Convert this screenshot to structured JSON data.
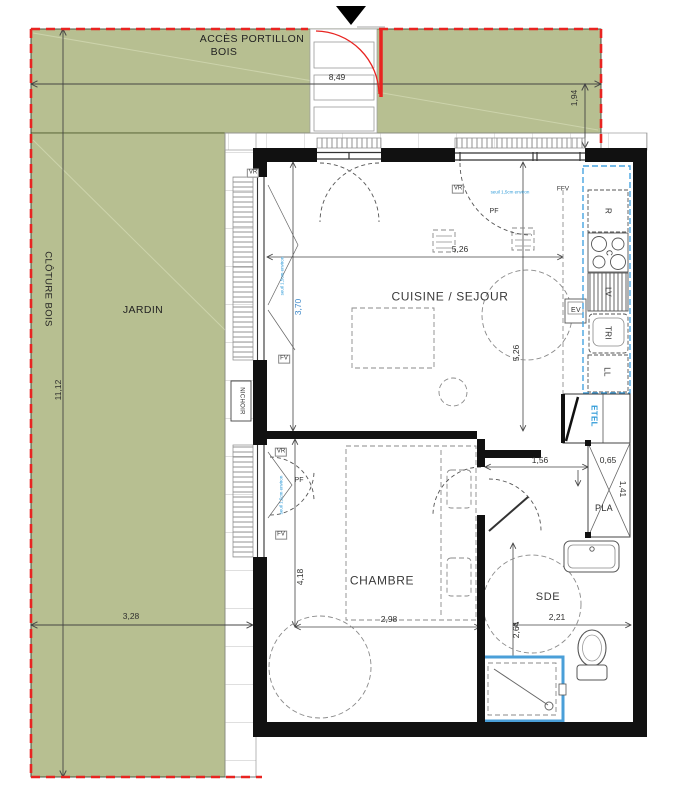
{
  "site": {
    "access_line1": "ACCÈS PORTILLON",
    "access_line2": "BOIS",
    "fence": "CLÔTURE BOIS",
    "garden": "JARDIN",
    "nichoir": "NICHOIR"
  },
  "rooms": {
    "living": "CUISINE / SEJOUR",
    "bedroom": "CHAMBRE",
    "bathroom": "SDE",
    "wardrobe": "PLA"
  },
  "kitchen": {
    "fridge": "R",
    "cooktop": "C",
    "dishwasher": "LV",
    "sink": "EV",
    "sorting": "TRI",
    "washer": "LL",
    "utility": "ETEL"
  },
  "openings": {
    "vr": "VR",
    "fv": "FV",
    "ffv": "FFV",
    "pf": "PF",
    "threshold": "seuil 1,5cm environ"
  },
  "dimensions": {
    "site_width": "8,49",
    "site_height": "11,12",
    "gate_return": "1,94",
    "garden_width": "3,28",
    "living_width": "5,26",
    "living_depth": "5,26",
    "bay_width": "3,70",
    "bedroom_depth": "4,18",
    "bedroom_width": "2,98",
    "hall_width": "1,56",
    "wardrobe_width": "0,65",
    "wardrobe_depth": "1,41",
    "bath_width": "2,21",
    "bath_depth": "2,64"
  },
  "colors": {
    "garden_green": "#b7bf91",
    "property_red": "#e82421",
    "accent_blue": "#2f9bd8",
    "wall_black": "#111111"
  }
}
